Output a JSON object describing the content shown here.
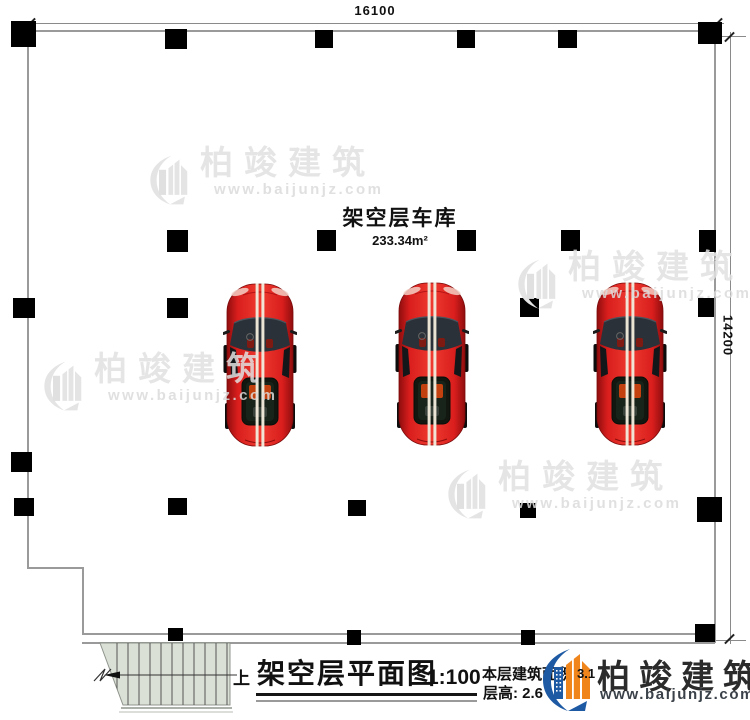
{
  "dimensions": {
    "top": "16100",
    "right": "14200"
  },
  "room": {
    "label": "架空层车库",
    "area": "233.34m²"
  },
  "title_block": {
    "stair_up_label": "上",
    "title": "架空层平面图",
    "scale": "1:100",
    "area_label": "本层建筑面积",
    "area_fragment": "3.1",
    "floor_height": "层高: 2.6",
    "brand": "柏竣建筑",
    "brand_url": "www.baijunjz.com"
  },
  "watermark": {
    "brand": "柏竣建筑",
    "url": "www.baijunjz.com",
    "positions": [
      {
        "left": 148,
        "top": 146
      },
      {
        "left": 516,
        "top": 250
      },
      {
        "left": 42,
        "top": 352
      },
      {
        "left": 446,
        "top": 460
      }
    ]
  },
  "plan": {
    "columns": [
      [
        11,
        21,
        25,
        26
      ],
      [
        165,
        29,
        22,
        20
      ],
      [
        315,
        30,
        18,
        18
      ],
      [
        457,
        30,
        18,
        18
      ],
      [
        558,
        30,
        19,
        18
      ],
      [
        698,
        22,
        24,
        22
      ],
      [
        167,
        230,
        21,
        22
      ],
      [
        317,
        230,
        19,
        21
      ],
      [
        457,
        230,
        19,
        21
      ],
      [
        561,
        230,
        19,
        21
      ],
      [
        699,
        230,
        17,
        22
      ],
      [
        13,
        298,
        22,
        20
      ],
      [
        167,
        298,
        21,
        20
      ],
      [
        520,
        298,
        19,
        19
      ],
      [
        698,
        298,
        16,
        19
      ],
      [
        11,
        452,
        21,
        20
      ],
      [
        14,
        498,
        20,
        18
      ],
      [
        168,
        498,
        19,
        17
      ],
      [
        348,
        500,
        18,
        16
      ],
      [
        520,
        503,
        16,
        15
      ],
      [
        697,
        497,
        25,
        25
      ],
      [
        168,
        628,
        15,
        13
      ],
      [
        347,
        630,
        14,
        15
      ],
      [
        521,
        630,
        14,
        15
      ],
      [
        695,
        624,
        20,
        18
      ]
    ],
    "cars": [
      {
        "left": 223,
        "top": 281
      },
      {
        "left": 395,
        "top": 280
      },
      {
        "left": 593,
        "top": 280
      }
    ]
  },
  "colors": {
    "car_red": "#e32322",
    "logo_blue": "#1e5aa4",
    "logo_orange": "#f0851c",
    "brand_dark": "#2b2b2b",
    "url_dark": "#3a4149"
  }
}
